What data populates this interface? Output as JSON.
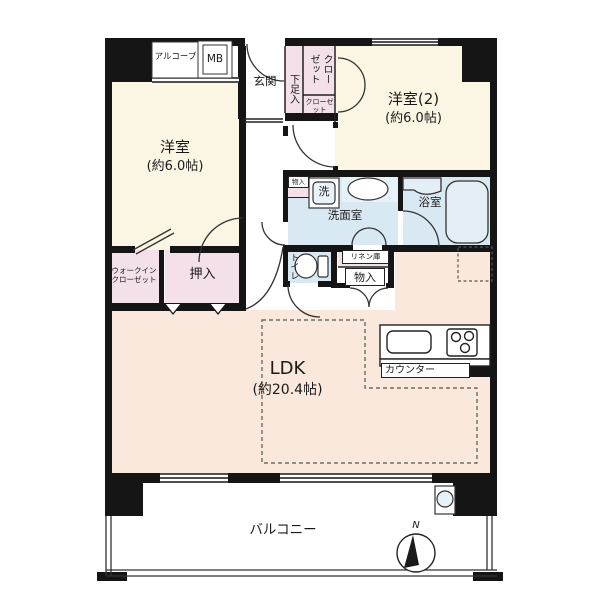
{
  "figure_type": "apartment-floor-plan",
  "floorplan": {
    "rooms": {
      "bedroom1": {
        "name": "洋室",
        "size": "(約6.0帖)"
      },
      "bedroom2": {
        "name": "洋室(2)",
        "size": "(約6.0帖)"
      },
      "ldk": {
        "name": "LDK",
        "size": "(約20.4帖)"
      },
      "entrance": {
        "name": "玄関"
      },
      "shoe_cabinet": {
        "name": "下足入"
      },
      "closet_main": {
        "name": "クローゼット"
      },
      "closet_sub": {
        "name": "クローゼット"
      },
      "alcove": {
        "name": "アルコーブ"
      },
      "meter_box": {
        "name": "MB"
      },
      "washroom": {
        "name": "洗面室"
      },
      "washing_machine": {
        "name": "洗"
      },
      "bathroom": {
        "name": "浴室"
      },
      "toilet": {
        "name": "トイレ"
      },
      "linen_closet": {
        "name": "リネン庫"
      },
      "storage_small": {
        "name": "物入"
      },
      "storage_hall": {
        "name": "物入"
      },
      "walk_in_closet": {
        "name": "ウォークインクローゼット"
      },
      "futon_closet": {
        "name": "押入"
      },
      "kitchen_counter": {
        "name": "カウンター"
      },
      "balcony": {
        "name": "バルコニー"
      }
    },
    "compass": {
      "label": "N"
    },
    "palette": {
      "wall": "#151515",
      "western_room": "#faf6e3",
      "closet_pink": "#f3e0e8",
      "wet_area_blue": "#d9e9f3",
      "ldk_peach": "#fae8dc",
      "background": "#ffffff"
    }
  }
}
